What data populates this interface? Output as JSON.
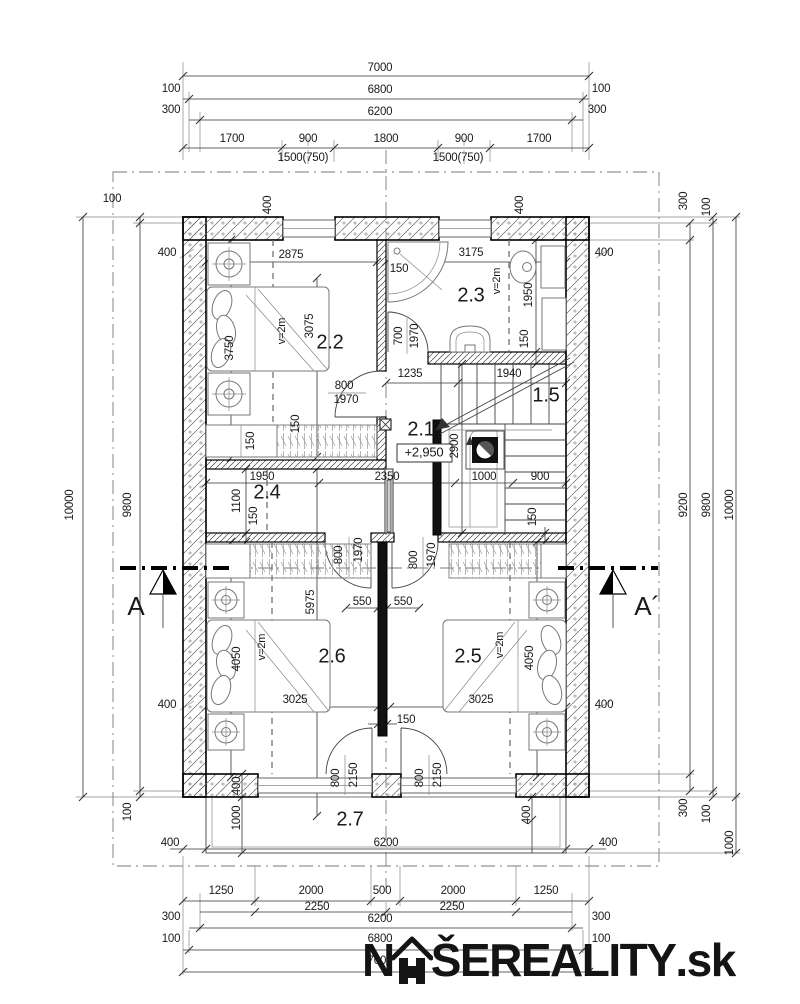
{
  "document": {
    "type": "floor-plan",
    "floor_label": "second floor",
    "level_mark": "+2,950"
  },
  "watermark": {
    "brand_prefix": "N",
    "brand_main": "ŠEREALITY",
    "brand_tld": ".sk",
    "icon": "house-roof-icon"
  },
  "rooms": [
    {
      "number": "2.1",
      "note": "+2,950"
    },
    {
      "number": "2.2",
      "note": "v=2m"
    },
    {
      "number": "2.3",
      "note": "v=2m"
    },
    {
      "number": "2.4"
    },
    {
      "number": "2.5",
      "note": "v=2m"
    },
    {
      "number": "2.6",
      "note": "v=2m"
    },
    {
      "number": "2.7"
    },
    {
      "number": "1.5"
    }
  ],
  "section_markers": [
    "A",
    "A´"
  ],
  "labels": [
    {
      "t": "7000",
      "x": 380,
      "y": 68
    },
    {
      "t": "100",
      "x": 171,
      "y": 89
    },
    {
      "t": "6800",
      "x": 380,
      "y": 90
    },
    {
      "t": "100",
      "x": 601,
      "y": 89
    },
    {
      "t": "300",
      "x": 171,
      "y": 110
    },
    {
      "t": "6200",
      "x": 380,
      "y": 112
    },
    {
      "t": "300",
      "x": 597,
      "y": 110
    },
    {
      "t": "1700",
      "x": 232,
      "y": 139
    },
    {
      "t": "900",
      "x": 308,
      "y": 139
    },
    {
      "t": "1800",
      "x": 386,
      "y": 139
    },
    {
      "t": "900",
      "x": 464,
      "y": 139
    },
    {
      "t": "1700",
      "x": 539,
      "y": 139
    },
    {
      "t": "1500(750)",
      "x": 303,
      "y": 158
    },
    {
      "t": "1500(750)",
      "x": 458,
      "y": 158
    },
    {
      "t": "100",
      "x": 112,
      "y": 199
    },
    {
      "t": "9800",
      "x": 128,
      "y": 505,
      "r": -90
    },
    {
      "t": "10000",
      "x": 70,
      "y": 505,
      "r": -90
    },
    {
      "t": "100",
      "x": 128,
      "y": 812,
      "r": -90
    },
    {
      "t": "300",
      "x": 684,
      "y": 201,
      "r": -90
    },
    {
      "t": "100",
      "x": 707,
      "y": 207,
      "r": -90
    },
    {
      "t": "9200",
      "x": 684,
      "y": 505,
      "r": -90
    },
    {
      "t": "9800",
      "x": 707,
      "y": 505,
      "r": -90
    },
    {
      "t": "10000",
      "x": 730,
      "y": 505,
      "r": -90
    },
    {
      "t": "300",
      "x": 684,
      "y": 808,
      "r": -90
    },
    {
      "t": "100",
      "x": 707,
      "y": 814,
      "r": -90
    },
    {
      "t": "1000",
      "x": 730,
      "y": 843,
      "r": -90
    },
    {
      "t": "1250",
      "x": 221,
      "y": 891
    },
    {
      "t": "2000",
      "x": 311,
      "y": 891
    },
    {
      "t": "500",
      "x": 382,
      "y": 891
    },
    {
      "t": "2000",
      "x": 453,
      "y": 891
    },
    {
      "t": "1250",
      "x": 546,
      "y": 891
    },
    {
      "t": "2250",
      "x": 317,
      "y": 907
    },
    {
      "t": "2250",
      "x": 452,
      "y": 907
    },
    {
      "t": "300",
      "x": 171,
      "y": 917
    },
    {
      "t": "6200",
      "x": 380,
      "y": 919
    },
    {
      "t": "300",
      "x": 601,
      "y": 917
    },
    {
      "t": "100",
      "x": 171,
      "y": 939
    },
    {
      "t": "6800",
      "x": 380,
      "y": 939
    },
    {
      "t": "100",
      "x": 601,
      "y": 939
    },
    {
      "t": "7000",
      "x": 380,
      "y": 961
    },
    {
      "t": "400",
      "x": 268,
      "y": 205,
      "r": -90
    },
    {
      "t": "400",
      "x": 520,
      "y": 205,
      "r": -90
    },
    {
      "t": "400",
      "x": 167,
      "y": 253
    },
    {
      "t": "400",
      "x": 604,
      "y": 253
    },
    {
      "t": "400",
      "x": 167,
      "y": 705
    },
    {
      "t": "400",
      "x": 604,
      "y": 705
    },
    {
      "t": "400",
      "x": 237,
      "y": 786,
      "r": -90
    },
    {
      "t": "1000",
      "x": 237,
      "y": 818,
      "r": -90
    },
    {
      "t": "400",
      "x": 527,
      "y": 815,
      "r": -90
    },
    {
      "t": "400",
      "x": 170,
      "y": 843
    },
    {
      "t": "6200",
      "x": 386,
      "y": 843
    },
    {
      "t": "400",
      "x": 608,
      "y": 843
    },
    {
      "t": "2.2",
      "x": 330,
      "y": 343,
      "k": "room"
    },
    {
      "t": "2875",
      "x": 291,
      "y": 255
    },
    {
      "t": "3075",
      "x": 310,
      "y": 326,
      "r": -90
    },
    {
      "t": "v=2m",
      "x": 282,
      "y": 331,
      "r": -90,
      "k": "note"
    },
    {
      "t": "3750",
      "x": 230,
      "y": 348,
      "r": -90
    },
    {
      "t": "150",
      "x": 296,
      "y": 424,
      "r": -90
    },
    {
      "t": "150",
      "x": 251,
      "y": 441,
      "r": -90
    },
    {
      "t": "800",
      "x": 344,
      "y": 386
    },
    {
      "t": "1970",
      "x": 346,
      "y": 400
    },
    {
      "t": "2.3",
      "x": 471,
      "y": 296,
      "k": "room"
    },
    {
      "t": "3175",
      "x": 471,
      "y": 253
    },
    {
      "t": "v=2m",
      "x": 497,
      "y": 281,
      "r": -90,
      "k": "note"
    },
    {
      "t": "150",
      "x": 399,
      "y": 269
    },
    {
      "t": "1950",
      "x": 529,
      "y": 295,
      "r": -90
    },
    {
      "t": "150",
      "x": 525,
      "y": 339,
      "r": -90
    },
    {
      "t": "700",
      "x": 399,
      "y": 336,
      "r": -90
    },
    {
      "t": "1970",
      "x": 415,
      "y": 336,
      "r": -90
    },
    {
      "t": "2.1",
      "x": 421,
      "y": 430,
      "k": "room"
    },
    {
      "t": "+2,950",
      "x": 424,
      "y": 453,
      "k": "level"
    },
    {
      "t": "1235",
      "x": 410,
      "y": 374
    },
    {
      "t": "1940",
      "x": 509,
      "y": 374
    },
    {
      "t": "1.5",
      "x": 546,
      "y": 396,
      "k": "room"
    },
    {
      "t": "2900",
      "x": 455,
      "y": 446,
      "r": -90
    },
    {
      "t": "1000",
      "x": 484,
      "y": 477
    },
    {
      "t": "900",
      "x": 540,
      "y": 477
    },
    {
      "t": "150",
      "x": 533,
      "y": 517,
      "r": -90
    },
    {
      "t": "2350",
      "x": 387,
      "y": 477
    },
    {
      "t": "1950",
      "x": 262,
      "y": 477
    },
    {
      "t": "2.4",
      "x": 267,
      "y": 493,
      "k": "room"
    },
    {
      "t": "1100",
      "x": 237,
      "y": 501,
      "r": -90
    },
    {
      "t": "150",
      "x": 254,
      "y": 516,
      "r": -90
    },
    {
      "t": "2.6",
      "x": 332,
      "y": 657,
      "k": "room"
    },
    {
      "t": "5975",
      "x": 311,
      "y": 602,
      "r": -90
    },
    {
      "t": "v=2m",
      "x": 262,
      "y": 647,
      "r": -90,
      "k": "note"
    },
    {
      "t": "4050",
      "x": 237,
      "y": 659,
      "r": -90
    },
    {
      "t": "3025",
      "x": 295,
      "y": 700
    },
    {
      "t": "800",
      "x": 339,
      "y": 555,
      "r": -90
    },
    {
      "t": "1970",
      "x": 359,
      "y": 550,
      "r": -90
    },
    {
      "t": "550",
      "x": 362,
      "y": 602
    },
    {
      "t": "550",
      "x": 403,
      "y": 602
    },
    {
      "t": "150",
      "x": 406,
      "y": 720
    },
    {
      "t": "800",
      "x": 336,
      "y": 778,
      "r": -90
    },
    {
      "t": "2150",
      "x": 354,
      "y": 775,
      "r": -90
    },
    {
      "t": "2.5",
      "x": 468,
      "y": 657,
      "k": "room"
    },
    {
      "t": "v=2m",
      "x": 500,
      "y": 645,
      "r": -90,
      "k": "note"
    },
    {
      "t": "4050",
      "x": 530,
      "y": 658,
      "r": -90
    },
    {
      "t": "3025",
      "x": 481,
      "y": 700
    },
    {
      "t": "800",
      "x": 414,
      "y": 560,
      "r": -90
    },
    {
      "t": "1970",
      "x": 432,
      "y": 555,
      "r": -90
    },
    {
      "t": "800",
      "x": 420,
      "y": 778,
      "r": -90
    },
    {
      "t": "2150",
      "x": 438,
      "y": 775,
      "r": -90
    },
    {
      "t": "2.7",
      "x": 350,
      "y": 820,
      "k": "room"
    },
    {
      "t": "A",
      "x": 136,
      "y": 608,
      "k": "section"
    },
    {
      "t": "A´",
      "x": 647,
      "y": 608,
      "k": "section"
    }
  ],
  "dim_lines": [
    {
      "o": "h",
      "y": 76,
      "x1": 183,
      "x2": 589,
      "ticks": [
        183,
        589
      ]
    },
    {
      "o": "h",
      "y": 99,
      "x1": 183,
      "x2": 589,
      "ticks": [
        189,
        583
      ]
    },
    {
      "o": "h",
      "y": 120,
      "x1": 189,
      "x2": 583,
      "ticks": [
        200,
        572
      ]
    },
    {
      "o": "h",
      "y": 148,
      "x1": 183,
      "x2": 589,
      "ticks": [
        183,
        282,
        334,
        438,
        490,
        589
      ]
    },
    {
      "o": "v",
      "x": 83,
      "y1": 217,
      "y2": 797,
      "ticks": [
        217,
        797
      ]
    },
    {
      "o": "v",
      "x": 140,
      "y1": 217,
      "y2": 797,
      "ticks": [
        217,
        223,
        791,
        797
      ]
    },
    {
      "o": "v",
      "x": 690,
      "y1": 223,
      "y2": 791,
      "ticks": [
        223,
        240,
        774,
        791
      ]
    },
    {
      "o": "v",
      "x": 713,
      "y1": 217,
      "y2": 797,
      "ticks": [
        217,
        223,
        791,
        797
      ]
    },
    {
      "o": "v",
      "x": 736,
      "y1": 217,
      "y2": 853,
      "ticks": [
        217,
        797,
        853
      ]
    },
    {
      "o": "h",
      "y": 901,
      "x1": 183,
      "x2": 589,
      "ticks": [
        183,
        255,
        371,
        400,
        516,
        589
      ]
    },
    {
      "o": "h",
      "y": 912,
      "x1": 200,
      "x2": 572,
      "ticks": [
        255,
        386,
        516
      ]
    },
    {
      "o": "h",
      "y": 928,
      "x1": 189,
      "x2": 583,
      "ticks": [
        200,
        572
      ]
    },
    {
      "o": "h",
      "y": 950,
      "x1": 183,
      "x2": 589,
      "ticks": [
        189,
        583
      ]
    },
    {
      "o": "h",
      "y": 972,
      "x1": 183,
      "x2": 589,
      "ticks": [
        183,
        589
      ]
    },
    {
      "o": "h",
      "y": 262,
      "x1": 206,
      "x2": 377,
      "ticks": [
        206,
        377
      ]
    },
    {
      "o": "h",
      "y": 262,
      "x1": 386,
      "x2": 566,
      "ticks": [
        386,
        566
      ]
    },
    {
      "o": "v",
      "x": 231,
      "y1": 240,
      "y2": 458,
      "ticks": [
        240,
        458
      ]
    },
    {
      "o": "v",
      "x": 317,
      "y1": 278,
      "y2": 457,
      "ticks": [
        278,
        457
      ]
    },
    {
      "o": "v",
      "x": 536,
      "y1": 240,
      "y2": 364,
      "ticks": [
        240,
        352,
        364
      ]
    },
    {
      "o": "h",
      "y": 383,
      "x1": 386,
      "x2": 566,
      "ticks": [
        386,
        458,
        566
      ]
    },
    {
      "o": "h",
      "y": 483,
      "x1": 206,
      "x2": 566,
      "ticks": [
        206,
        319,
        455,
        513,
        566
      ]
    },
    {
      "o": "v",
      "x": 246,
      "y1": 469,
      "y2": 542,
      "ticks": [
        469,
        533,
        542
      ]
    },
    {
      "o": "v",
      "x": 462,
      "y1": 364,
      "y2": 533,
      "ticks": [
        364,
        533
      ]
    },
    {
      "o": "v",
      "x": 545,
      "y1": 527,
      "y2": 542,
      "ticks": [
        533,
        542
      ]
    },
    {
      "o": "v",
      "x": 317,
      "y1": 469,
      "y2": 816,
      "ticks": [
        469,
        816
      ]
    },
    {
      "o": "v",
      "x": 231,
      "y1": 542,
      "y2": 777,
      "ticks": [
        542,
        777
      ]
    },
    {
      "o": "v",
      "x": 537,
      "y1": 542,
      "y2": 777,
      "ticks": [
        542,
        777
      ]
    },
    {
      "o": "h",
      "y": 707,
      "x1": 206,
      "x2": 378,
      "ticks": [
        206,
        378
      ]
    },
    {
      "o": "h",
      "y": 707,
      "x1": 390,
      "x2": 566,
      "ticks": [
        390,
        566
      ]
    },
    {
      "o": "h",
      "y": 608,
      "x1": 346,
      "x2": 378,
      "ticks": [
        346,
        378
      ]
    },
    {
      "o": "h",
      "y": 608,
      "x1": 387,
      "x2": 419,
      "ticks": [
        387,
        419
      ]
    },
    {
      "o": "h",
      "y": 724,
      "x1": 368,
      "x2": 397,
      "ticks": [
        378,
        387
      ]
    },
    {
      "o": "v",
      "x": 242,
      "y1": 774,
      "y2": 853,
      "ticks": [
        774,
        797,
        853
      ]
    },
    {
      "o": "v",
      "x": 532,
      "y1": 797,
      "y2": 853,
      "ticks": [
        797,
        820
      ]
    },
    {
      "o": "h",
      "y": 849,
      "x1": 170,
      "x2": 606,
      "ticks": [
        183,
        206,
        566,
        589
      ]
    }
  ]
}
